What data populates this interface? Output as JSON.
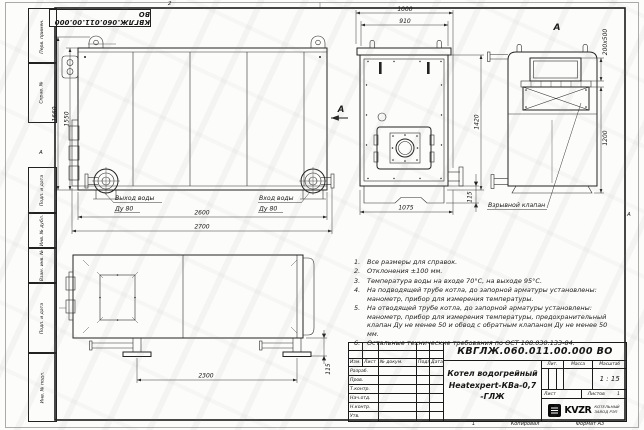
{
  "stamp": {
    "doc_number_top": "КВГЛЖ.060.011.00.000 ВО"
  },
  "frame": {
    "left_fields": [
      "Перв. примен.",
      "Справ. №",
      "Подп. и дата",
      "Инв. № дубл.",
      "Взам. инв. №",
      "Подп. и дата",
      "Инв. № подл."
    ],
    "zone_top": "2",
    "zone_left": "А",
    "zone_right": "А",
    "sheet_mark": "1"
  },
  "views": {
    "front": {
      "dims": {
        "height_outer": "1660",
        "height_inner": "1550",
        "width_inner": "2600",
        "width_outer": "2700"
      },
      "outlet_label": "Выход воды",
      "outlet_dn": "Ду 80",
      "inlet_label": "Вход воды",
      "inlet_dn": "Ду 80"
    },
    "side": {
      "dims": {
        "top_outer": "1000",
        "top_inner": "910",
        "height": "1420",
        "bottom": "1075",
        "foot": "115"
      },
      "section_arrow": "А"
    },
    "view_a": {
      "label": "А",
      "dims": {
        "valve_size": "200х500",
        "height": "1200"
      },
      "valve_label": "Взрывной клапан"
    },
    "plan": {
      "dims": {
        "length": "2300",
        "foot": "115"
      }
    }
  },
  "notes": [
    "Все размеры для справок.",
    "Отклонения ±100 мм.",
    "Температура воды на входе 70°С, на выходе 95°С.",
    "На подводящей трубе котла, до запорной арматуры установлены: манометр, прибор для измерения температуры.",
    "На отводящей трубе котла, до запорной арматуры установлены: манометр, прибор для измерения температуры, предохранительный клапан Ду не менее 50 и обвод с обратным клапаном Ду не менее 50 мм.",
    "Остальные технические требования по ОСТ 108.030.133-84."
  ],
  "title_block": {
    "doc_number": "КВГЛЖ.060.011.00.000 ВО",
    "product_name_line1": "Котел водогрейный",
    "product_name_line2": "Heatexpert-КВа-0,7 -ГЛЖ",
    "header_cols": [
      "Изм.",
      "Лист",
      "№ докум.",
      "Подп.",
      "Дата"
    ],
    "rows": [
      "Разраб.",
      "Пров.",
      "Т.контр.",
      "Нач.отд.",
      "Н.контр.",
      "Утв."
    ],
    "lit_label": "Лит.",
    "mass_label": "Масса",
    "scale_label": "Масштаб",
    "scale_value": "1 : 15",
    "sheet_label": "Лист",
    "sheets_label": "Листов",
    "sheets_value": "1",
    "company_logo": "KVZR",
    "company_name_line1": "КОТЕЛЬНЫЙ",
    "company_name_line2": "ЗАВОД РЭП",
    "copied_label": "Копировал",
    "format_label": "Формат А3"
  }
}
